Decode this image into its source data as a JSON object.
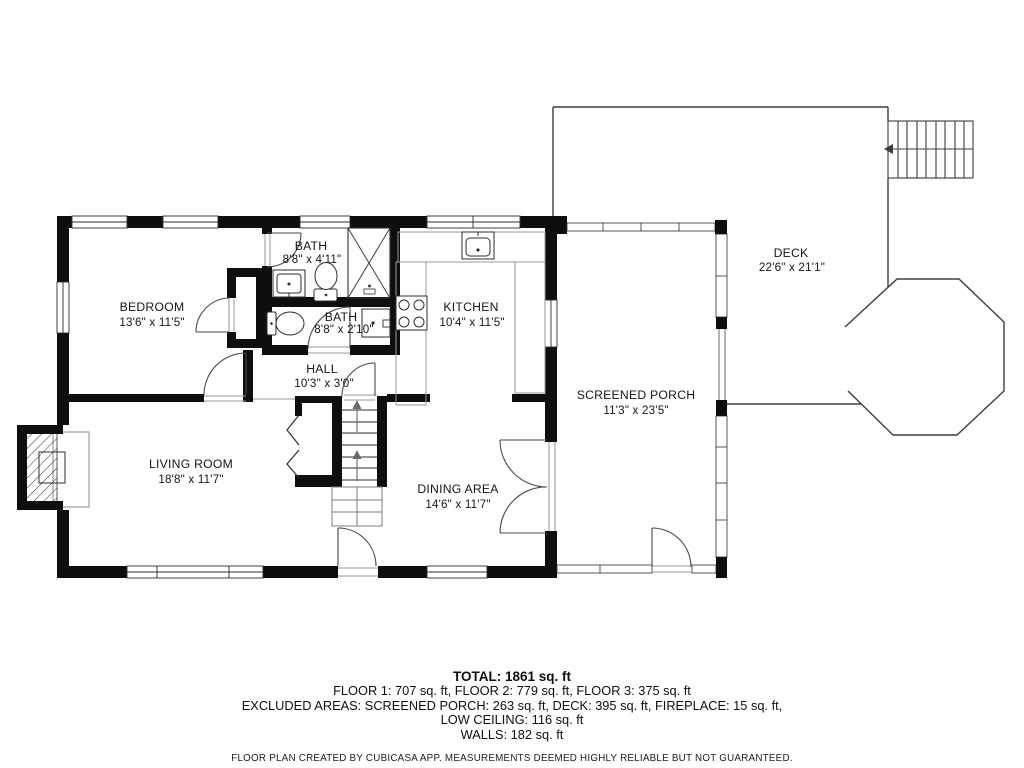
{
  "rooms": {
    "bedroom": {
      "name": "BEDROOM",
      "dims": "13'6\" x 11'5\""
    },
    "bath_upper": {
      "name": "BATH",
      "dims": "8'8\" x 4'11\""
    },
    "bath_lower": {
      "name": "BATH",
      "dims": "8'8\" x 2'10\""
    },
    "hall": {
      "name": "HALL",
      "dims": "10'3\" x 3'0\""
    },
    "kitchen": {
      "name": "KITCHEN",
      "dims": "10'4\" x 11'5\""
    },
    "living_room": {
      "name": "LIVING ROOM",
      "dims": "18'8\" x 11'7\""
    },
    "dining_area": {
      "name": "DINING AREA",
      "dims": "14'6\" x 11'7\""
    },
    "screened_porch": {
      "name": "SCREENED PORCH",
      "dims": "11'3\" x 23'5\""
    },
    "deck": {
      "name": "DECK",
      "dims": "22'6\" x 21'1\""
    }
  },
  "summary": {
    "total": "TOTAL: 1861 sq. ft",
    "floors": "FLOOR 1: 707 sq. ft, FLOOR 2: 779 sq. ft, FLOOR 3: 375 sq. ft",
    "excluded": "EXCLUDED AREAS: SCREENED PORCH: 263 sq. ft, DECK: 395 sq. ft, FIREPLACE: 15 sq. ft,",
    "low_ceiling": "LOW CEILING: 116 sq. ft",
    "walls": "WALLS: 182 sq. ft",
    "disclaimer": "FLOOR PLAN CREATED BY CUBICASA APP. MEASUREMENTS DEEMED HIGHLY RELIABLE BUT NOT GUARANTEED."
  },
  "colors": {
    "wall": "#0e0e0e",
    "line": "#3d3d3d",
    "light_line": "#9a9a9a",
    "background": "#ffffff"
  }
}
